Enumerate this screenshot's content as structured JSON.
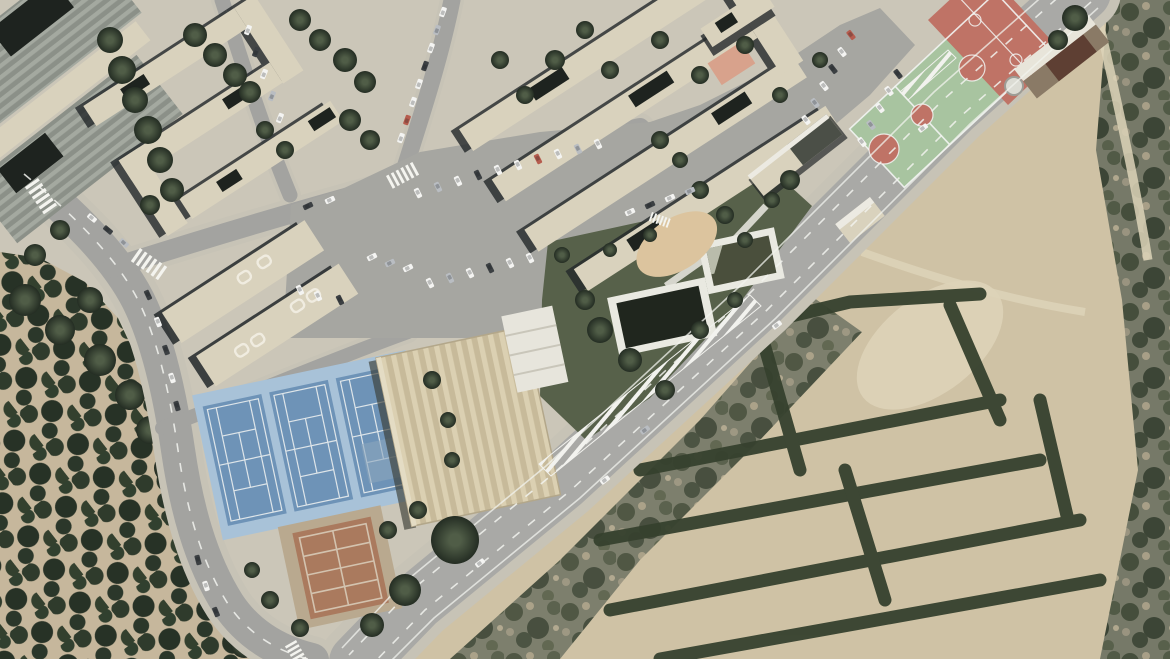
{
  "scene": {
    "type": "satellite-aerial-photograph",
    "description": "Aerial view of a Mediterranean town edge: apartment blocks and factory roofs top-left, large car parks in the centre, red and green basketball courts top-right, three blue tennis courts with a beige warehouse and a clay court mid-left, two dark irrigation ponds in a garden, a wide avenue crossing diagonally, palm groves lower-left and palm-lined farm fields lower-right.",
    "palette": {
      "urban_ground": "#cbc6b8",
      "road_asphalt": "#a3a3a0",
      "avenue_asphalt": "#a9a9a6",
      "sidewalk": "#c7c3b6",
      "lane_marking": "#f4f4ef",
      "parking_asphalt": "#a6a6a1",
      "building_beige": "#d9d2bd",
      "building_shadow": "#23282a",
      "roof_dark_patch": "#1e231f",
      "factory_rib_light": "#a4a9a0",
      "factory_rib_dark": "#8b9088",
      "warehouse_rib_light": "#dbd0b2",
      "warehouse_rib_dark": "#c7ba9a",
      "tennis_apron": "#a8c2d8",
      "tennis_court_blue": "#6e93b7",
      "sport_green": "#a8c4a0",
      "sport_red": "#bf7366",
      "clay_court": "#aa7a5e",
      "clay_surround": "#b9a98f",
      "pond_rim": "#e9e9e1",
      "pond_water_dark": "#20261e",
      "pond_water_olive": "#4a4f3c",
      "garden_green": "#57614a",
      "tree_green_dark": "#2c372a",
      "palm_soil": "#c6b79c",
      "field_tan": "#cfc2a5",
      "field_sand": "#ddd3b8",
      "scrub_base": "#767968",
      "playground_sand": "#dcc49e",
      "playground_salmon": "#d8a28c",
      "car_white": "#f4f4f2",
      "car_dark": "#3c4043",
      "car_silver": "#b9bdc2",
      "car_red": "#b65c4e"
    },
    "features": [
      {
        "name": "factory-sheds",
        "kind": "industrial ribbed roofs",
        "area": "top-left corner"
      },
      {
        "name": "apartment-complex-northwest",
        "kind": "housing slabs with tree courtyards",
        "area": "top-left"
      },
      {
        "name": "apartment-complex-north",
        "kind": "parallel housing slabs",
        "area": "top-centre"
      },
      {
        "name": "apartment-blocks-west",
        "kind": "two housing slabs",
        "area": "mid-left"
      },
      {
        "name": "main-parking-lot",
        "kind": "asphalt car park with parked cars",
        "area": "centre"
      },
      {
        "name": "east-parking-strip",
        "kind": "angled parking rows",
        "area": "centre-right"
      },
      {
        "name": "basketball-court-red",
        "kind": "red sport court with white lines",
        "area": "top-right"
      },
      {
        "name": "basketball-court-green",
        "kind": "green court, red keys and centre circle",
        "area": "top-right"
      },
      {
        "name": "courts-clubhouse",
        "kind": "small building, white and brown roof",
        "area": "top-right"
      },
      {
        "name": "tennis-courts",
        "kind": "three blue courts on light-blue apron",
        "count": 3,
        "area": "mid-left"
      },
      {
        "name": "sports-warehouse",
        "kind": "large beige ribbed roof hall",
        "area": "centre-left"
      },
      {
        "name": "clay-court",
        "kind": "small terracotta court",
        "area": "bottom-left of centre"
      },
      {
        "name": "irrigation-pond-large",
        "kind": "dark water basin with white rim",
        "area": "centre"
      },
      {
        "name": "irrigation-pond-small",
        "kind": "olive water basin with white rim",
        "area": "centre"
      },
      {
        "name": "garden",
        "kind": "dark green garden with trees",
        "area": "centre"
      },
      {
        "name": "main-avenue",
        "kind": "wide diagonal road with lane markings and hatched median",
        "area": "bottom-left to top-right"
      },
      {
        "name": "west-road",
        "kind": "curving two-lane street with crosswalks",
        "area": "left edge"
      },
      {
        "name": "palm-grove",
        "kind": "dense palm plantation on tan soil",
        "area": "bottom-left"
      },
      {
        "name": "farm-fields",
        "kind": "tan plots bordered by palm rows",
        "area": "bottom-right"
      },
      {
        "name": "scrubland",
        "kind": "dark mottled wasteland",
        "area": "right edge"
      },
      {
        "name": "cars",
        "kind": "parked and moving vehicles",
        "approx_count": 60
      }
    ]
  }
}
